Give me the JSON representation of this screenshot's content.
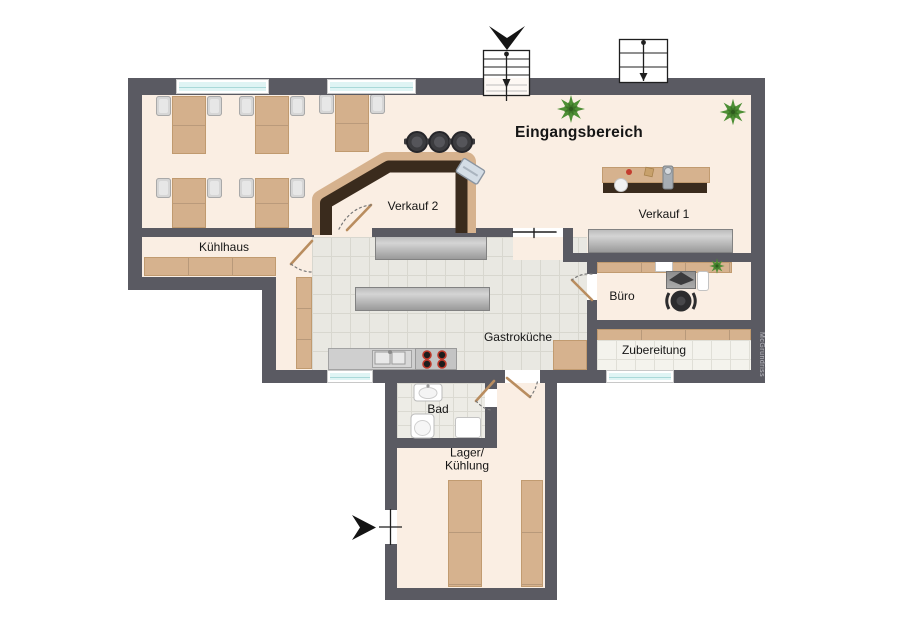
{
  "rooms": {
    "eingangsbereich": "Eingangsbereich",
    "verkauf_2": "Verkauf 2",
    "verkauf_1": "Verkauf 1",
    "kuehlhaus": "Kühlhaus",
    "buero": "Büro",
    "gastrokueche": "Gastroküche",
    "zubereitung": "Zubereitung",
    "bad": "Bad",
    "lager_kuehlung_line1": "Lager/",
    "lager_kuehlung_line2": "Kühlung"
  },
  "watermark": "McGrundriss",
  "icons": {
    "entrance_arrow_top": "chevron-down",
    "entrance_arrow_side": "triangle-right",
    "staircase_main": "stairs-with-run-line",
    "staircase_secondary": "stairs-with-run-line",
    "plant": "green-plant",
    "soup_pot": "round-pot",
    "cash_register": "register-box",
    "door_swing": "quarter-arc"
  },
  "colors": {
    "wall": "#5a5a62",
    "floor": "#faeee3",
    "tile_floor": "#e9e8e2",
    "wood": "#d6b28e",
    "counter_dark": "#3a2b1d",
    "stainless": "#b5b5b5",
    "window": "#dff4f4",
    "plant": "#4d8f35",
    "accent_red": "#c0392b"
  }
}
